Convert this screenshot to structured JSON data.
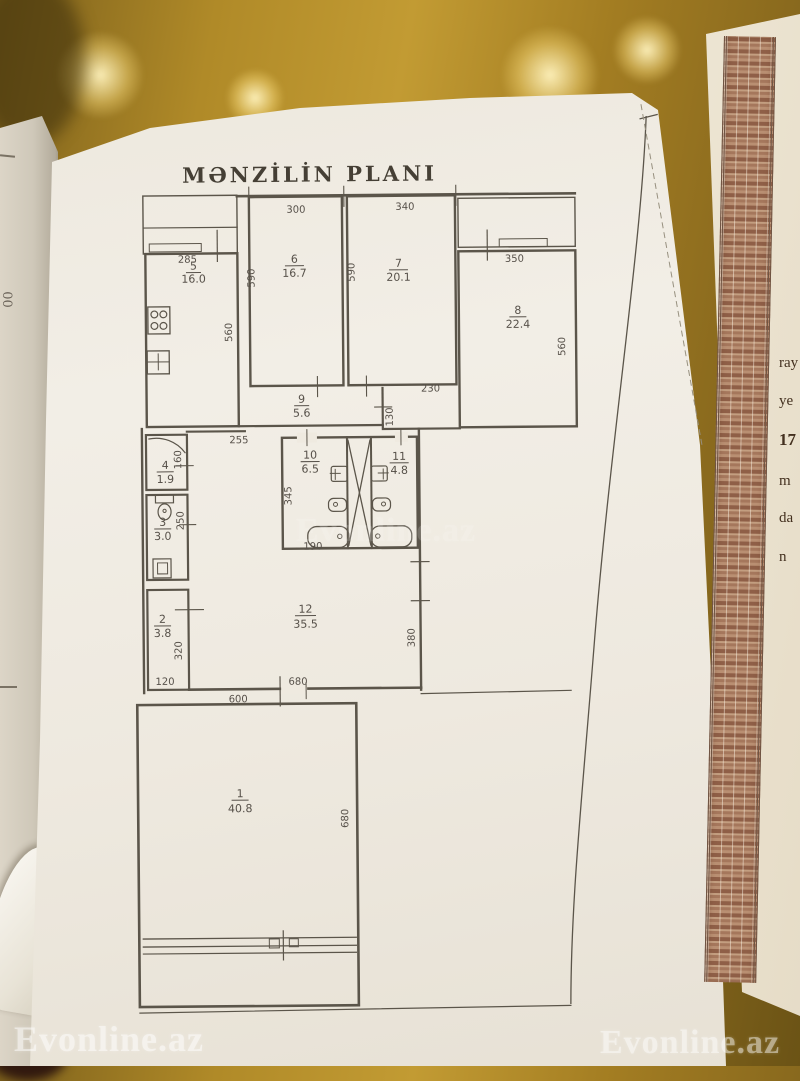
{
  "plan": {
    "title": "MƏNZİLİN PLANI",
    "rooms": {
      "r1": {
        "num": "1",
        "area": "40.8"
      },
      "r2": {
        "num": "2",
        "area": "3.8"
      },
      "r3": {
        "num": "3",
        "area": "3.0"
      },
      "r4": {
        "num": "4",
        "area": "1.9"
      },
      "r5": {
        "num": "5",
        "area": "16.0"
      },
      "r6": {
        "num": "6",
        "area": "16.7"
      },
      "r7": {
        "num": "7",
        "area": "20.1"
      },
      "r8": {
        "num": "8",
        "area": "22.4"
      },
      "r9": {
        "num": "9",
        "area": "5.6"
      },
      "r10": {
        "num": "10",
        "area": "6.5"
      },
      "r11": {
        "num": "11",
        "area": "4.8"
      },
      "r12": {
        "num": "12",
        "area": "35.5"
      }
    },
    "dims": {
      "balcony_kitchen": "285",
      "room6_top": "300",
      "room7_top": "340",
      "room8_top": "350",
      "room6_left": "590",
      "room7_left": "590",
      "room5_right": "560",
      "room8_right": "560",
      "corridor_right_top": "230",
      "passage_height": "130",
      "hall_opening": "255",
      "room4_right": "160",
      "room3_right": "250",
      "room10_left": "345",
      "room10_bottom": "190",
      "room2_right": "320",
      "room2_bottom": "120",
      "room12_right": "380",
      "room12_bottom": "680",
      "room1_top": "600",
      "room1_right": "680"
    }
  },
  "watermark": {
    "text": "Evonline.az"
  },
  "certificate_fragment": {
    "visible_chars": [
      "ray",
      "ye",
      "17",
      "m",
      "da",
      "n"
    ]
  },
  "underlying_page": {
    "visible_text": "00"
  },
  "colors": {
    "ink": "#57514a",
    "paper": "#efeae0",
    "table_gold": "#b08a28",
    "certificate_border": "#a5775c"
  }
}
